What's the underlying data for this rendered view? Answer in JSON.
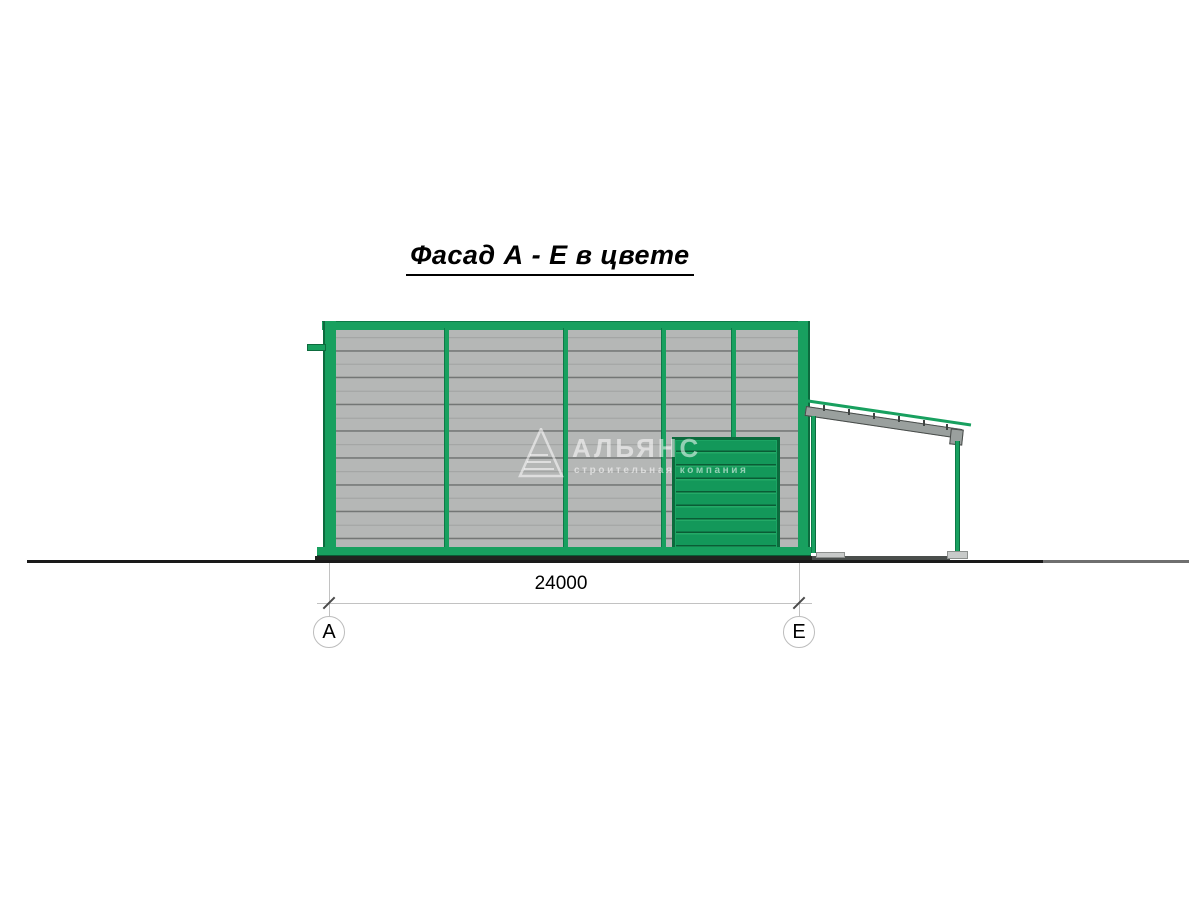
{
  "title": {
    "text": "Фасад А - Е в цвете"
  },
  "dimension": {
    "value": "24000"
  },
  "axes": {
    "left": {
      "label": "А"
    },
    "right": {
      "label": "Е"
    }
  },
  "watermark": {
    "brand": "АЛЬЯНС",
    "tagline": "строительная компания",
    "logo": "triangle-logo-icon"
  },
  "colors": {
    "frame_green": "#18a05f",
    "door_green": "#129254",
    "panel_gray": "#b5b7b6",
    "joint_gray": "#737675",
    "ground_black": "#1a1a1a"
  }
}
